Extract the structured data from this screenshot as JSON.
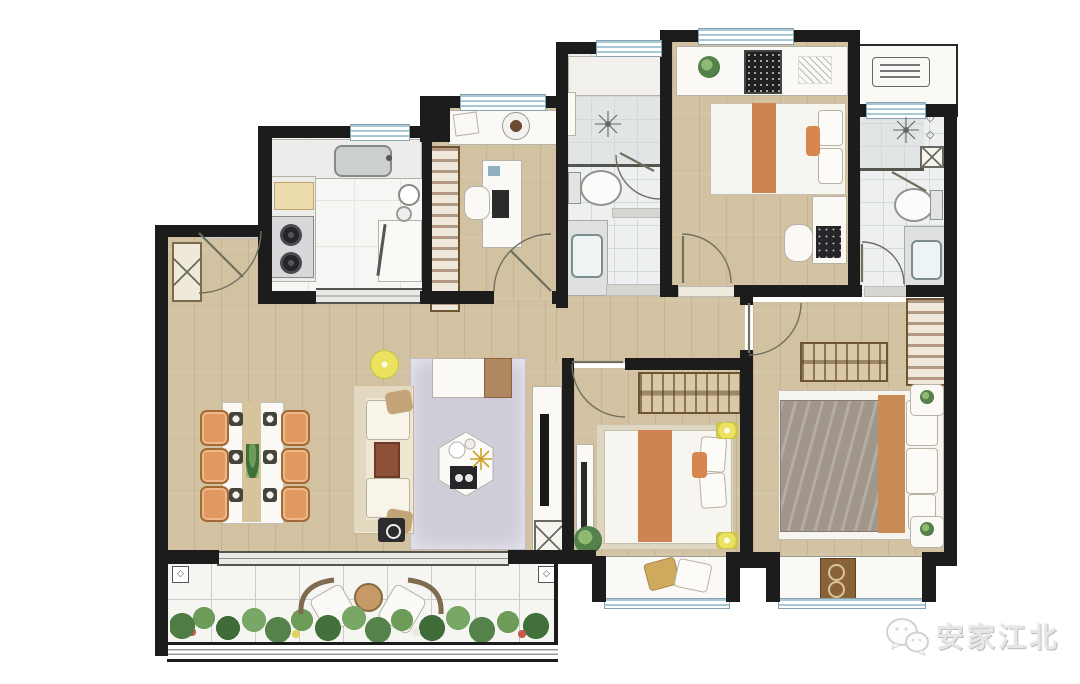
{
  "watermark": {
    "brand_text": "安家江北",
    "icon": "wechat-logo-icon"
  },
  "icons": {
    "fixture_diamond": "◇"
  },
  "palette": {
    "wall": "#1c1c1c",
    "wood_floor": "#d2c2a1",
    "tile_floor": "#edeff0",
    "kitchen_marble": "#f6f6f4",
    "window_glass": "#a9c8d6",
    "accent_orange": "#cd8450",
    "accent_yellow": "#ebe25f",
    "living_rug": "#d0cdd9",
    "bedroom_rug": "#ded6c1",
    "plant_green": "#55824a",
    "sofa_cream": "#efe7d1"
  },
  "rooms": {
    "ids": [
      "entry",
      "kitchen",
      "study",
      "interior-hallway",
      "bathroom-1",
      "bedroom-2",
      "bathroom-2",
      "ac-platform",
      "living-dining-room",
      "balcony",
      "bedroom-3",
      "master-bedroom"
    ]
  }
}
